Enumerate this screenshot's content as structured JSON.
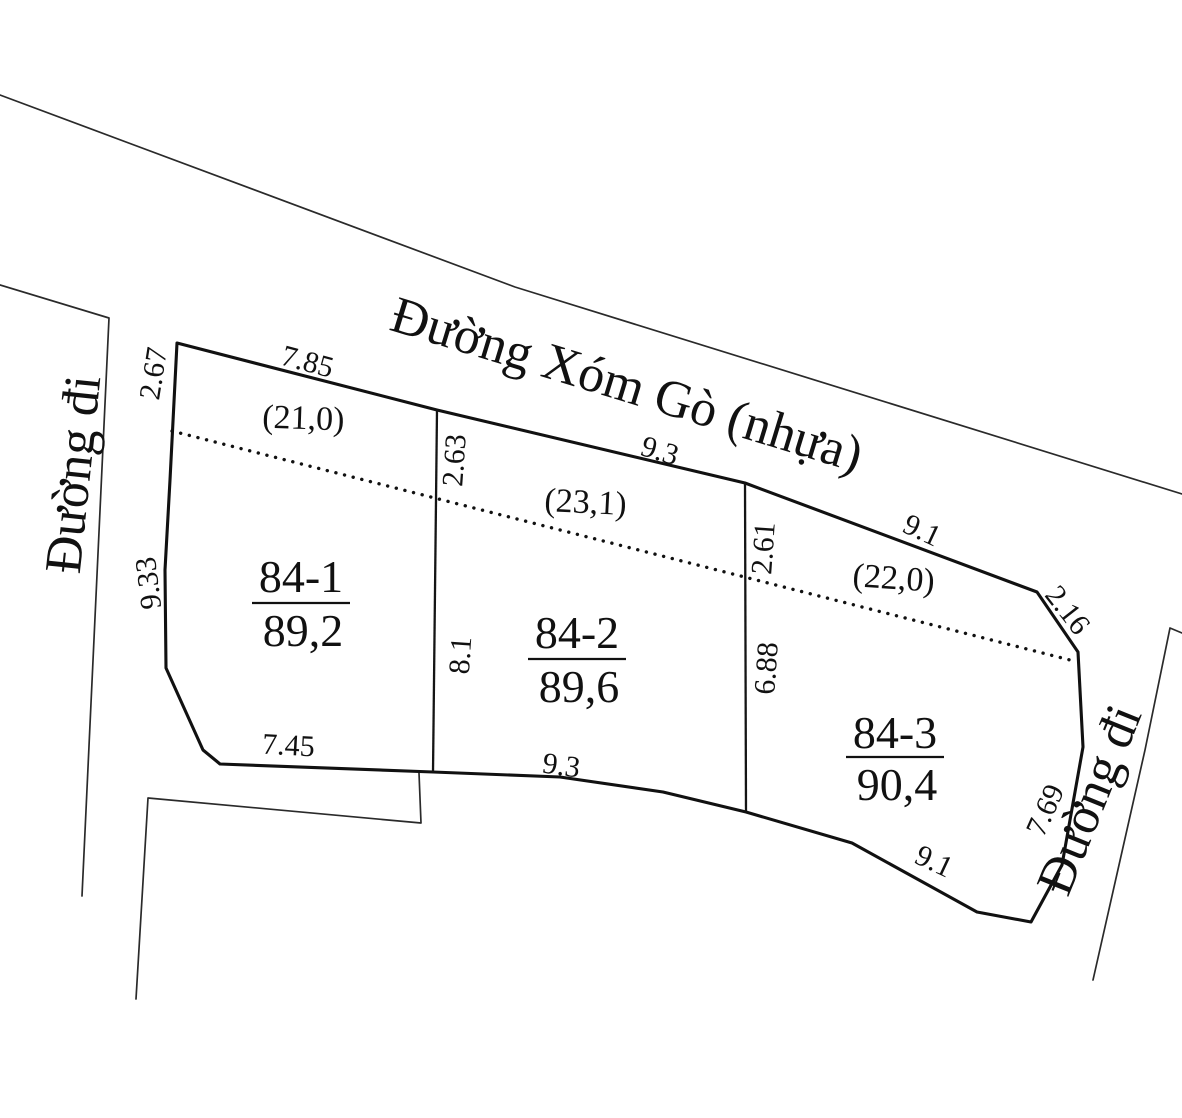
{
  "drawing": {
    "type": "cadastral-land-sketch",
    "colors": {
      "ink": "#111111",
      "background": "#ffffff"
    }
  },
  "roads": {
    "top": {
      "label": "Đường Xóm Gò (nhựa)"
    },
    "left": {
      "label": "Đường đi"
    },
    "right": {
      "label": "Đường đi"
    }
  },
  "parcels": [
    {
      "id": "84-1",
      "area": "89,2",
      "setback_area": "(21,0)",
      "dims": {
        "top": "7.85",
        "left_upper": "2.67",
        "left_lower": "9.33",
        "right_upper": "2.63",
        "right_lower": "8.1",
        "bottom": "7.45"
      }
    },
    {
      "id": "84-2",
      "area": "89,6",
      "setback_area": "(23,1)",
      "dims": {
        "top": "9.3",
        "right_upper": "2.61",
        "right_lower": "6.88",
        "bottom": "9.3"
      }
    },
    {
      "id": "84-3",
      "area": "90,4",
      "setback_area": "(22,0)",
      "dims": {
        "top": "9.1",
        "right_upper": "2.16",
        "right_lower": "7.69",
        "bottom": "9.1"
      }
    }
  ]
}
